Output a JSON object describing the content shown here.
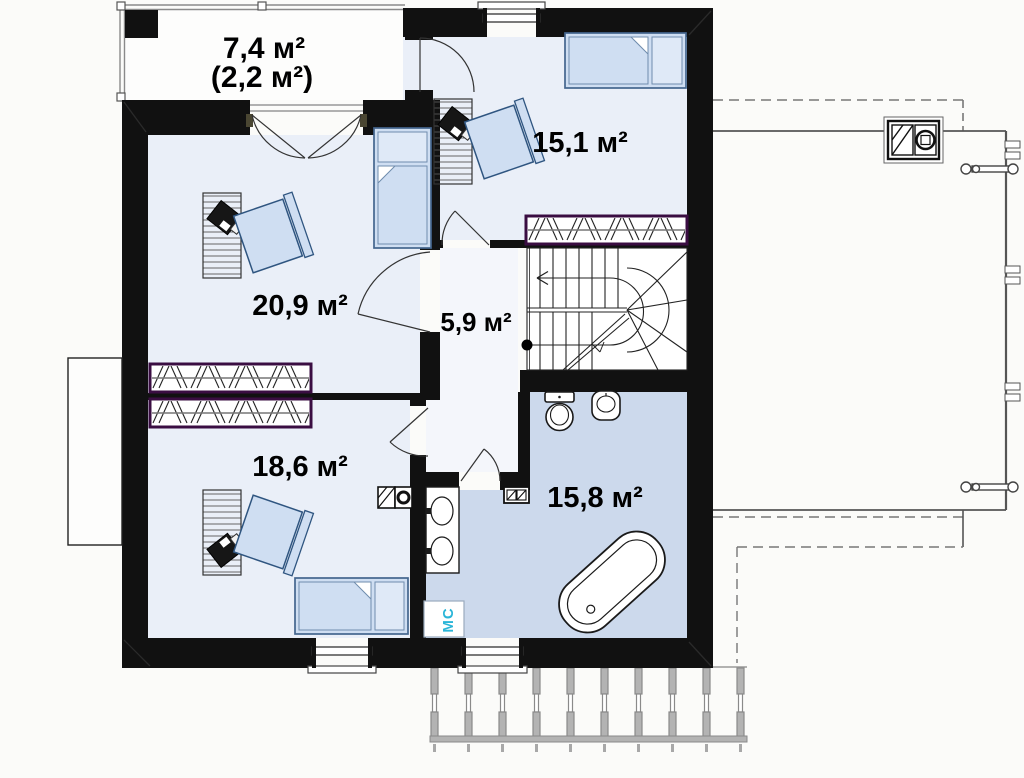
{
  "plan": {
    "name": "Floor plan (attic level)",
    "rooms": [
      {
        "id": "terrace",
        "area": "7,4 м²",
        "area_note": "(2,2 м²)"
      },
      {
        "id": "bedroom-1",
        "area": "15,1 м²"
      },
      {
        "id": "bedroom-2",
        "area": "20,9 м²"
      },
      {
        "id": "hallway",
        "area": "5,9 м²"
      },
      {
        "id": "bedroom-3",
        "area": "18,6 м²"
      },
      {
        "id": "bathroom",
        "area": "15,8 м²"
      }
    ],
    "annotations": {
      "washing_machine": "МС"
    },
    "colors": {
      "wall": "#111111",
      "room_fill": "#eaeff8",
      "hall_fill": "#f4f6fb",
      "bathroom_fill": "#ccd9ec",
      "furniture_fill": "#cfdef2",
      "pillow_fill": "#dfe9f7",
      "furniture_stroke": "#44658e",
      "wardrobe_border": "#3a0d42",
      "washing_machine_text": "#2ab5d8",
      "railing": "#999999"
    }
  }
}
